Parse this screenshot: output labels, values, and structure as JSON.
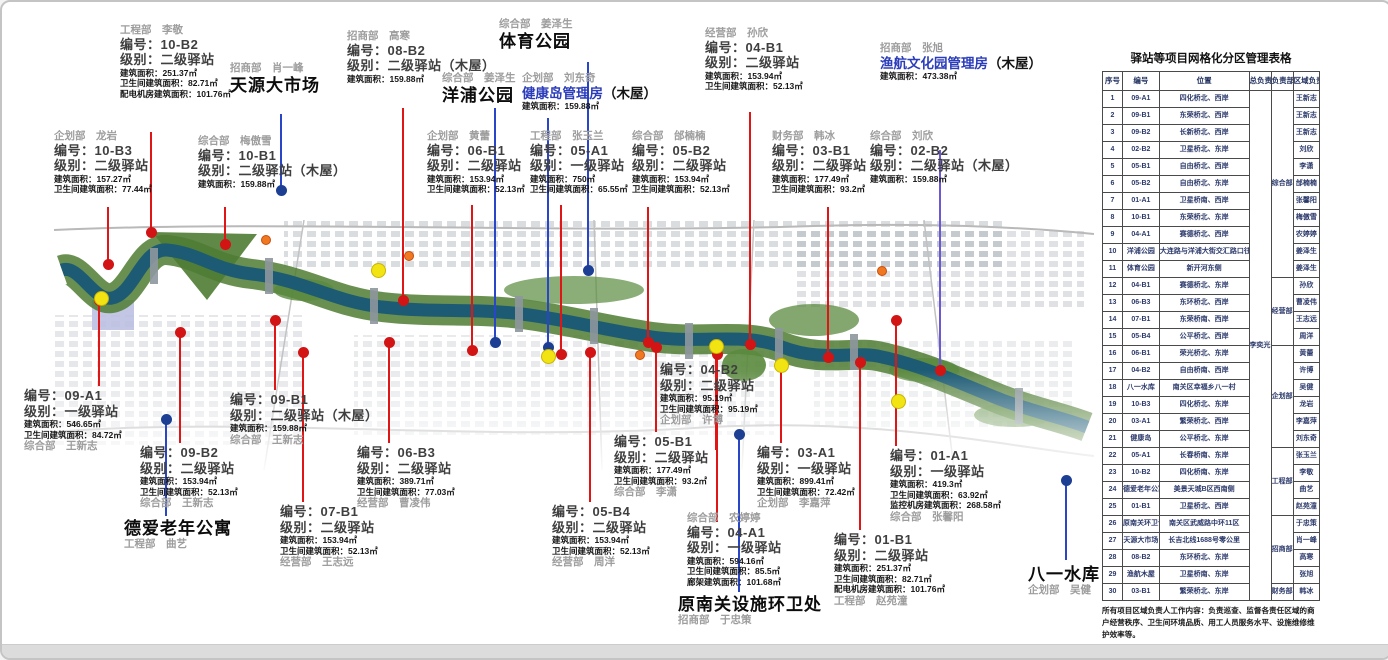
{
  "table": {
    "title": "驿站等项目网格化分区管理表格",
    "headers": [
      "序号",
      "编号",
      "位置",
      "总负责人",
      "负责部门",
      "区域负责人"
    ],
    "chief": "李奕光",
    "dept_groups": [
      {
        "label": "综合部",
        "from": 1,
        "to": 11
      },
      {
        "label": "经营部",
        "from": 12,
        "to": 15
      },
      {
        "label": "企划部",
        "from": 16,
        "to": 21
      },
      {
        "label": "工程部",
        "from": 22,
        "to": 25
      },
      {
        "label": "招商部",
        "from": 26,
        "to": 29
      },
      {
        "label": "财务部",
        "from": 30,
        "to": 30
      }
    ],
    "rows": [
      {
        "no": 1,
        "code": "09-A1",
        "location": "四化桥北、西岸",
        "manager": "王新志"
      },
      {
        "no": 2,
        "code": "09-B1",
        "location": "东荣桥北、西岸",
        "manager": "王新志"
      },
      {
        "no": 3,
        "code": "09-B2",
        "location": "长新桥北、西岸",
        "manager": "王新志"
      },
      {
        "no": 4,
        "code": "02-B2",
        "location": "卫星桥北、东岸",
        "manager": "刘欣"
      },
      {
        "no": 5,
        "code": "05-B1",
        "location": "自由桥北、西岸",
        "manager": "李潇"
      },
      {
        "no": 6,
        "code": "05-B2",
        "location": "自由桥北、东岸",
        "manager": "邰楠楠"
      },
      {
        "no": 7,
        "code": "01-A1",
        "location": "卫星桥南、西岸",
        "manager": "张馨阳"
      },
      {
        "no": 8,
        "code": "10-B1",
        "location": "东荣桥北、东岸",
        "manager": "梅傲雪"
      },
      {
        "no": 9,
        "code": "04-A1",
        "location": "赛德桥北、西岸",
        "manager": "农婷婷"
      },
      {
        "no": 10,
        "code": "洋浦公园",
        "location": "大连路与洋浦大街交汇路口往西约60米",
        "manager": "姜泽生"
      },
      {
        "no": 11,
        "code": "体育公园",
        "location": "新开河东侧",
        "manager": "姜泽生"
      },
      {
        "no": 12,
        "code": "04-B1",
        "location": "赛德桥北、东岸",
        "manager": "孙欣"
      },
      {
        "no": 13,
        "code": "06-B3",
        "location": "东环桥北、西岸",
        "manager": "曹凌伟"
      },
      {
        "no": 14,
        "code": "07-B1",
        "location": "东荣桥南、西岸",
        "manager": "王志远"
      },
      {
        "no": 15,
        "code": "05-B4",
        "location": "公平桥北、西岸",
        "manager": "周洋"
      },
      {
        "no": 16,
        "code": "06-B1",
        "location": "荣光桥北、东岸",
        "manager": "黄蕾"
      },
      {
        "no": 17,
        "code": "04-B2",
        "location": "自由桥南、西岸",
        "manager": "许博"
      },
      {
        "no": 18,
        "code": "八一水库",
        "location": "南关区幸福乡八一村",
        "manager": "吴健"
      },
      {
        "no": 19,
        "code": "10-B3",
        "location": "四化桥北、东岸",
        "manager": "龙岩"
      },
      {
        "no": 20,
        "code": "03-A1",
        "location": "繁荣桥北、西岸",
        "manager": "李嘉萍"
      },
      {
        "no": 21,
        "code": "健康岛",
        "location": "公平桥北、东岸",
        "manager": "刘东奇"
      },
      {
        "no": 22,
        "code": "05-A1",
        "location": "长春桥南、东岸",
        "manager": "张玉兰"
      },
      {
        "no": 23,
        "code": "10-B2",
        "location": "四化桥南、东岸",
        "manager": "李敬"
      },
      {
        "no": 24,
        "code": "德爱老年公寓",
        "location": "美景天城B区西南侧",
        "manager": "曲艺"
      },
      {
        "no": 25,
        "code": "01-B1",
        "location": "卫星桥北、西岸",
        "manager": "赵苑潼"
      },
      {
        "no": 26,
        "code": "原南关环卫设施处",
        "location": "南关区武威路中环11区",
        "manager": "于忠策"
      },
      {
        "no": 27,
        "code": "天源大市场",
        "location": "长吉北线1688号零公里",
        "manager": "肖一峰"
      },
      {
        "no": 28,
        "code": "08-B2",
        "location": "东环桥北、东岸",
        "manager": "高寒"
      },
      {
        "no": 29,
        "code": "渔航木屋",
        "location": "卫星桥南、东岸",
        "manager": "张旭"
      },
      {
        "no": 30,
        "code": "03-B1",
        "location": "繁荣桥北、东岸",
        "manager": "韩冰"
      }
    ],
    "footnote": "所有项目区域负责人工作内容：负责巡查、监督各责任区域的商户经营秩序、卫生间环境品质、用工人员服务水平、设施维修维护效率等。"
  },
  "map": {
    "stations": [
      {
        "id": "10-B2",
        "x": 118,
        "y": 22,
        "attr": "工程部　李敬",
        "attr_pos": "top",
        "code": "编号：10-B2",
        "level": "级别：二级驿站",
        "metrics": [
          "建筑面积：251.37㎡",
          "卫生间建筑面积：82.71㎡",
          "配电机房建筑面积：101.76㎡"
        ]
      },
      {
        "id": "10-B3",
        "x": 52,
        "y": 128,
        "attr": "企划部　龙岩",
        "attr_pos": "top",
        "code": "编号：10-B3",
        "level": "级别：二级驿站",
        "metrics": [
          "建筑面积：157.27㎡",
          "卫生间建筑面积：77.44㎡"
        ]
      },
      {
        "id": "10-B1",
        "x": 196,
        "y": 133,
        "attr": "综合部　梅傲雪",
        "attr_pos": "top",
        "code": "编号：10-B1",
        "level": "级别：二级驿站（木屋）",
        "metrics": [
          "建筑面积：159.88㎡"
        ]
      },
      {
        "id": "08-B2",
        "x": 345,
        "y": 28,
        "attr": "招商部　高寒",
        "attr_pos": "top",
        "code": "编号：08-B2",
        "level": "级别：二级驿站（木屋）",
        "metrics": [
          "建筑面积：159.88㎡"
        ]
      },
      {
        "id": "06-B1",
        "x": 425,
        "y": 128,
        "attr": "企划部　黄蕾",
        "attr_pos": "top",
        "code": "编号：06-B1",
        "level": "级别：二级驿站",
        "metrics": [
          "建筑面积：153.94㎡",
          "卫生间建筑面积：52.13㎡"
        ]
      },
      {
        "id": "05-A1",
        "x": 528,
        "y": 128,
        "attr": "工程部　张玉兰",
        "attr_pos": "top",
        "code": "编号：05-A1",
        "level": "级别：一级驿站",
        "metrics": [
          "建筑面积：750㎡",
          "卫生间建筑面积：65.55㎡"
        ]
      },
      {
        "id": "05-B2",
        "x": 630,
        "y": 128,
        "attr": "综合部　邰楠楠",
        "attr_pos": "top",
        "code": "编号：05-B2",
        "level": "级别：二级驿站",
        "metrics": [
          "建筑面积：153.94㎡",
          "卫生间建筑面积：52.13㎡"
        ]
      },
      {
        "id": "04-B1",
        "x": 703,
        "y": 25,
        "attr": "经营部　孙欣",
        "attr_pos": "top",
        "code": "编号：04-B1",
        "level": "级别：二级驿站",
        "metrics": [
          "建筑面积：153.94㎡",
          "卫生间建筑面积：52.13㎡"
        ]
      },
      {
        "id": "03-B1",
        "x": 770,
        "y": 128,
        "attr": "财务部　韩冰",
        "attr_pos": "top",
        "code": "编号：03-B1",
        "level": "级别：二级驿站",
        "metrics": [
          "建筑面积：177.49㎡",
          "卫生间建筑面积：93.2㎡"
        ]
      },
      {
        "id": "02-B2",
        "x": 868,
        "y": 128,
        "attr": "综合部　刘欣",
        "attr_pos": "top",
        "code": "编号：02-B2",
        "level": "级别：二级驿站（木屋）",
        "metrics": [
          "建筑面积：159.88㎡"
        ]
      },
      {
        "id": "09-A1",
        "x": 22,
        "y": 386,
        "attr": "综合部　王新志",
        "attr_pos": "bottom",
        "code": "编号：09-A1",
        "level": "级别：一级驿站",
        "metrics": [
          "建筑面积：546.65㎡",
          "卫生间建筑面积：84.72㎡"
        ]
      },
      {
        "id": "09-B2",
        "x": 138,
        "y": 443,
        "attr": "综合部　王新志",
        "attr_pos": "bottom",
        "code": "编号：09-B2",
        "level": "级别：二级驿站",
        "metrics": [
          "建筑面积：153.94㎡",
          "卫生间建筑面积：52.13㎡"
        ]
      },
      {
        "id": "09-B1",
        "x": 228,
        "y": 390,
        "attr": "综合部　王新志",
        "attr_pos": "bottom",
        "code": "编号：09-B1",
        "level": "级别：二级驿站（木屋）",
        "metrics": [
          "建筑面积：159.88㎡"
        ]
      },
      {
        "id": "07-B1",
        "x": 278,
        "y": 502,
        "attr": "经营部　王志远",
        "attr_pos": "bottom",
        "code": "编号：07-B1",
        "level": "级别：二级驿站",
        "metrics": [
          "建筑面积：153.94㎡",
          "卫生间建筑面积：52.13㎡"
        ]
      },
      {
        "id": "06-B3",
        "x": 355,
        "y": 443,
        "attr": "经营部　曹凌伟",
        "attr_pos": "bottom",
        "code": "编号：06-B3",
        "level": "级别：二级驿站",
        "metrics": [
          "建筑面积：389.71㎡",
          "卫生间建筑面积：77.03㎡"
        ]
      },
      {
        "id": "05-B4",
        "x": 550,
        "y": 502,
        "attr": "经营部　周洋",
        "attr_pos": "bottom",
        "code": "编号：05-B4",
        "level": "级别：二级驿站",
        "metrics": [
          "建筑面积：153.94㎡",
          "卫生间建筑面积：52.13㎡"
        ]
      },
      {
        "id": "05-B1",
        "x": 612,
        "y": 432,
        "attr": "综合部　李潇",
        "attr_pos": "bottom",
        "code": "编号：05-B1",
        "level": "级别：二级驿站",
        "metrics": [
          "建筑面积：177.49㎡",
          "卫生间建筑面积：93.2㎡"
        ]
      },
      {
        "id": "04-B2",
        "x": 658,
        "y": 360,
        "attr": "企划部　许博",
        "attr_pos": "bottom",
        "code": "编号：04-B2",
        "level": "级别：二级驿站",
        "metrics": [
          "建筑面积：95.19㎡",
          "卫生间建筑面积：95.19㎡"
        ]
      },
      {
        "id": "04-A1",
        "x": 685,
        "y": 510,
        "attr": "综合部　农婷婷",
        "attr_pos": "top",
        "code": "编号：04-A1",
        "level": "级别：一级驿站",
        "metrics": [
          "建筑面积：594.16㎡",
          "卫生间建筑面积：85.5㎡",
          "廊架建筑面积：101.68㎡"
        ]
      },
      {
        "id": "03-A1",
        "x": 755,
        "y": 443,
        "attr": "企划部　李嘉萍",
        "attr_pos": "bottom",
        "code": "编号：03-A1",
        "level": "级别：一级驿站",
        "metrics": [
          "建筑面积：899.41㎡",
          "卫生间建筑面积：72.42㎡"
        ]
      },
      {
        "id": "01-B1",
        "x": 832,
        "y": 530,
        "attr": "工程部　赵苑潼",
        "attr_pos": "bottom",
        "code": "编号：01-B1",
        "level": "级别：二级驿站",
        "metrics": [
          "建筑面积：251.37㎡",
          "卫生间建筑面积：82.71㎡",
          "配电机房建筑面积：101.76㎡"
        ]
      },
      {
        "id": "01-A1",
        "x": 888,
        "y": 446,
        "attr": "综合部　张馨阳",
        "attr_pos": "bottom",
        "code": "编号：01-A1",
        "level": "级别：一级驿站",
        "metrics": [
          "建筑面积：419.3㎡",
          "卫生间建筑面积：63.92㎡",
          "监控机房建筑面积：268.58㎡"
        ]
      }
    ],
    "places": [
      {
        "name": "天源大市场",
        "style": "black",
        "attr": "招商部　肖一峰",
        "attr_pos": "top",
        "x": 228,
        "y": 60,
        "metrics": []
      },
      {
        "name": "体育公园",
        "style": "black",
        "attr": "综合部　姜泽生",
        "attr_pos": "top",
        "x": 497,
        "y": 16,
        "metrics": []
      },
      {
        "name": "洋浦公园",
        "style": "black",
        "attr": "综合部　姜泽生",
        "attr_pos": "top",
        "x": 440,
        "y": 70,
        "metrics": []
      },
      {
        "name": "健康岛管理房",
        "suffix": "（木屋）",
        "style": "blue",
        "attr": "企划部　刘东奇",
        "attr_pos": "top",
        "x": 520,
        "y": 70,
        "metrics": [
          "建筑面积：159.88㎡"
        ]
      },
      {
        "name": "渔航文化园管理房",
        "suffix": "（木屋）",
        "style": "blue",
        "attr": "招商部　张旭",
        "attr_pos": "top",
        "x": 878,
        "y": 40,
        "metrics": [
          "建筑面积：473.38㎡"
        ]
      },
      {
        "name": "德爱老年公寓",
        "style": "black",
        "attr": "工程部　曲艺",
        "attr_pos": "bottom",
        "x": 122,
        "y": 516,
        "metrics": []
      },
      {
        "name": "原南关设施环卫处",
        "style": "black",
        "attr": "招商部　于忠策",
        "attr_pos": "bottom",
        "x": 676,
        "y": 592,
        "metrics": []
      },
      {
        "name": "八一水库",
        "style": "black",
        "attr": "企划部　吴健",
        "attr_pos": "bottom",
        "x": 1026,
        "y": 562,
        "metrics": []
      }
    ],
    "pins": [
      {
        "x": 105,
        "y1": 205,
        "y2": 262,
        "color": "red",
        "dot": "bottom"
      },
      {
        "x": 148,
        "y1": 130,
        "y2": 230,
        "color": "red",
        "dot": "bottom"
      },
      {
        "x": 222,
        "y1": 205,
        "y2": 242,
        "color": "red",
        "dot": "bottom"
      },
      {
        "x": 278,
        "y1": 112,
        "y2": 188,
        "color": "blue",
        "dot": "bottom"
      },
      {
        "x": 400,
        "y1": 106,
        "y2": 298,
        "color": "red",
        "dot": "bottom"
      },
      {
        "x": 469,
        "y1": 203,
        "y2": 348,
        "color": "red",
        "dot": "bottom"
      },
      {
        "x": 492,
        "y1": 106,
        "y2": 340,
        "color": "blue",
        "dot": "bottom"
      },
      {
        "x": 585,
        "y1": 60,
        "y2": 268,
        "color": "blue",
        "dot": "bottom"
      },
      {
        "x": 545,
        "y1": 116,
        "y2": 345,
        "color": "blue",
        "dot": "bottom"
      },
      {
        "x": 558,
        "y1": 203,
        "y2": 352,
        "color": "red",
        "dot": "bottom"
      },
      {
        "x": 645,
        "y1": 205,
        "y2": 340,
        "color": "red",
        "dot": "bottom"
      },
      {
        "x": 747,
        "y1": 110,
        "y2": 342,
        "color": "red",
        "dot": "bottom"
      },
      {
        "x": 825,
        "y1": 205,
        "y2": 355,
        "color": "red",
        "dot": "bottom"
      },
      {
        "x": 937,
        "y1": 148,
        "y2": 368,
        "color": "purple",
        "dot": "bottom",
        "dot_color": "red"
      },
      {
        "x": 96,
        "y1": 298,
        "y2": 384,
        "color": "red",
        "dot": "top"
      },
      {
        "x": 177,
        "y1": 330,
        "y2": 441,
        "color": "red",
        "dot": "top"
      },
      {
        "x": 163,
        "y1": 417,
        "y2": 514,
        "color": "blue",
        "dot": "top"
      },
      {
        "x": 272,
        "y1": 318,
        "y2": 388,
        "color": "red",
        "dot": "top"
      },
      {
        "x": 300,
        "y1": 350,
        "y2": 500,
        "color": "red",
        "dot": "top"
      },
      {
        "x": 386,
        "y1": 340,
        "y2": 441,
        "color": "red",
        "dot": "top"
      },
      {
        "x": 587,
        "y1": 350,
        "y2": 500,
        "color": "red",
        "dot": "top"
      },
      {
        "x": 653,
        "y1": 345,
        "y2": 430,
        "color": "red",
        "dot": "top"
      },
      {
        "x": 713,
        "y1": 345,
        "y2": 448,
        "color": "red",
        "dot": "none"
      },
      {
        "x": 714,
        "y1": 352,
        "y2": 520,
        "color": "red",
        "dot": "top"
      },
      {
        "x": 736,
        "y1": 432,
        "y2": 590,
        "color": "blue",
        "dot": "top"
      },
      {
        "x": 778,
        "y1": 364,
        "y2": 441,
        "color": "red",
        "dot": "none"
      },
      {
        "x": 857,
        "y1": 360,
        "y2": 528,
        "color": "red",
        "dot": "top"
      },
      {
        "x": 893,
        "y1": 318,
        "y2": 444,
        "color": "red",
        "dot": "top"
      },
      {
        "x": 1063,
        "y1": 478,
        "y2": 558,
        "color": "blue",
        "dot": "top"
      }
    ],
    "yellow_dots": [
      {
        "x": 98,
        "y": 295
      },
      {
        "x": 375,
        "y": 267
      },
      {
        "x": 545,
        "y": 353
      },
      {
        "x": 713,
        "y": 343
      },
      {
        "x": 778,
        "y": 362
      },
      {
        "x": 895,
        "y": 398
      }
    ],
    "orange_marks": [
      {
        "x": 263,
        "y": 237
      },
      {
        "x": 406,
        "y": 253
      },
      {
        "x": 637,
        "y": 352
      },
      {
        "x": 879,
        "y": 268
      }
    ],
    "colors": {
      "pin_red": "#e01616",
      "pin_blue": "#2a46c8",
      "pin_purple": "#6a58d6",
      "dot_red": "#d21414",
      "dot_blue": "#1c3f93",
      "dot_yellow": "#f2e313",
      "river": "#1d5b74",
      "bank_green": "#4f7c33"
    }
  }
}
